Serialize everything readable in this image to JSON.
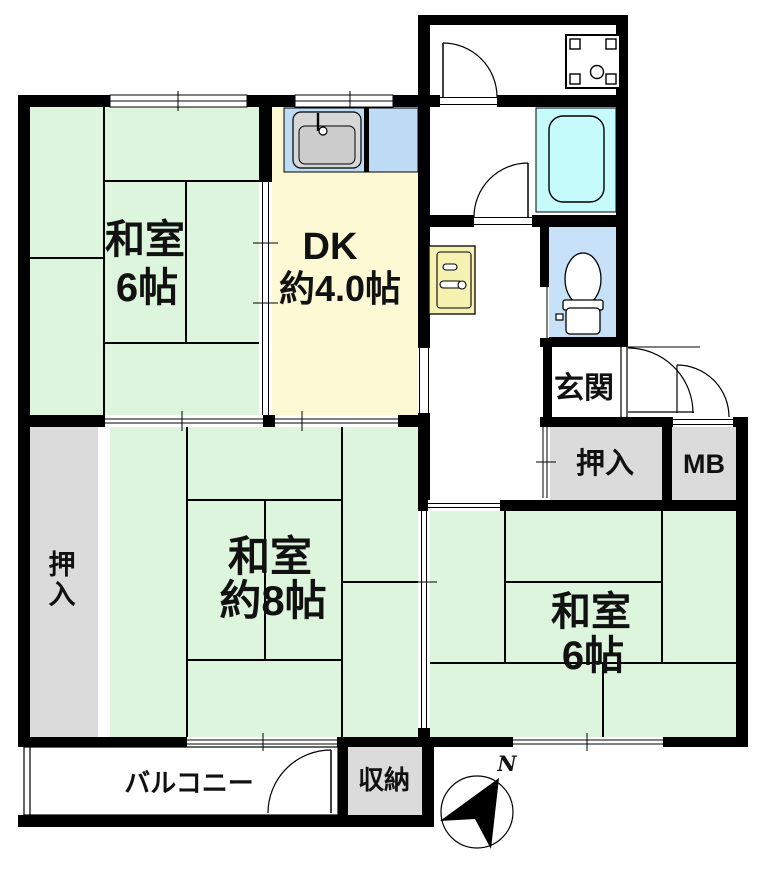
{
  "plan_title": "2DK apartment floor plan",
  "rooms": {
    "washitsu_nw": {
      "name": "和室",
      "size": "6帖"
    },
    "dk": {
      "name": "DK",
      "size": "約4.0帖"
    },
    "washitsu_center": {
      "name": "和室",
      "size": "約8帖"
    },
    "washitsu_se": {
      "name": "和室",
      "size": "6帖"
    },
    "genkan": {
      "label": "玄関"
    },
    "oshiire_right": {
      "label": "押入"
    },
    "oshiire_left": {
      "label": "押入",
      "chars": [
        "押",
        "入"
      ]
    },
    "mb": {
      "label": "MB"
    },
    "balcony": {
      "label": "バルコニー"
    },
    "shuno": {
      "label": "収納"
    }
  },
  "compass": {
    "north_label": "N"
  },
  "colors": {
    "wall": "#000000",
    "tatami_green": "#ddf5dd",
    "dk_yellow": "#fcf9d4",
    "closet_gray": "#dbdbdb",
    "counter_blue": "#bedcf6",
    "toilet_blue": "#c6e1f8",
    "bath_cyan": "#c6fbfb",
    "basin_yellow": "#f6f2b2",
    "fixture_gray": "#d7d7d7",
    "fixture_gray_dark": "#cccccc"
  }
}
